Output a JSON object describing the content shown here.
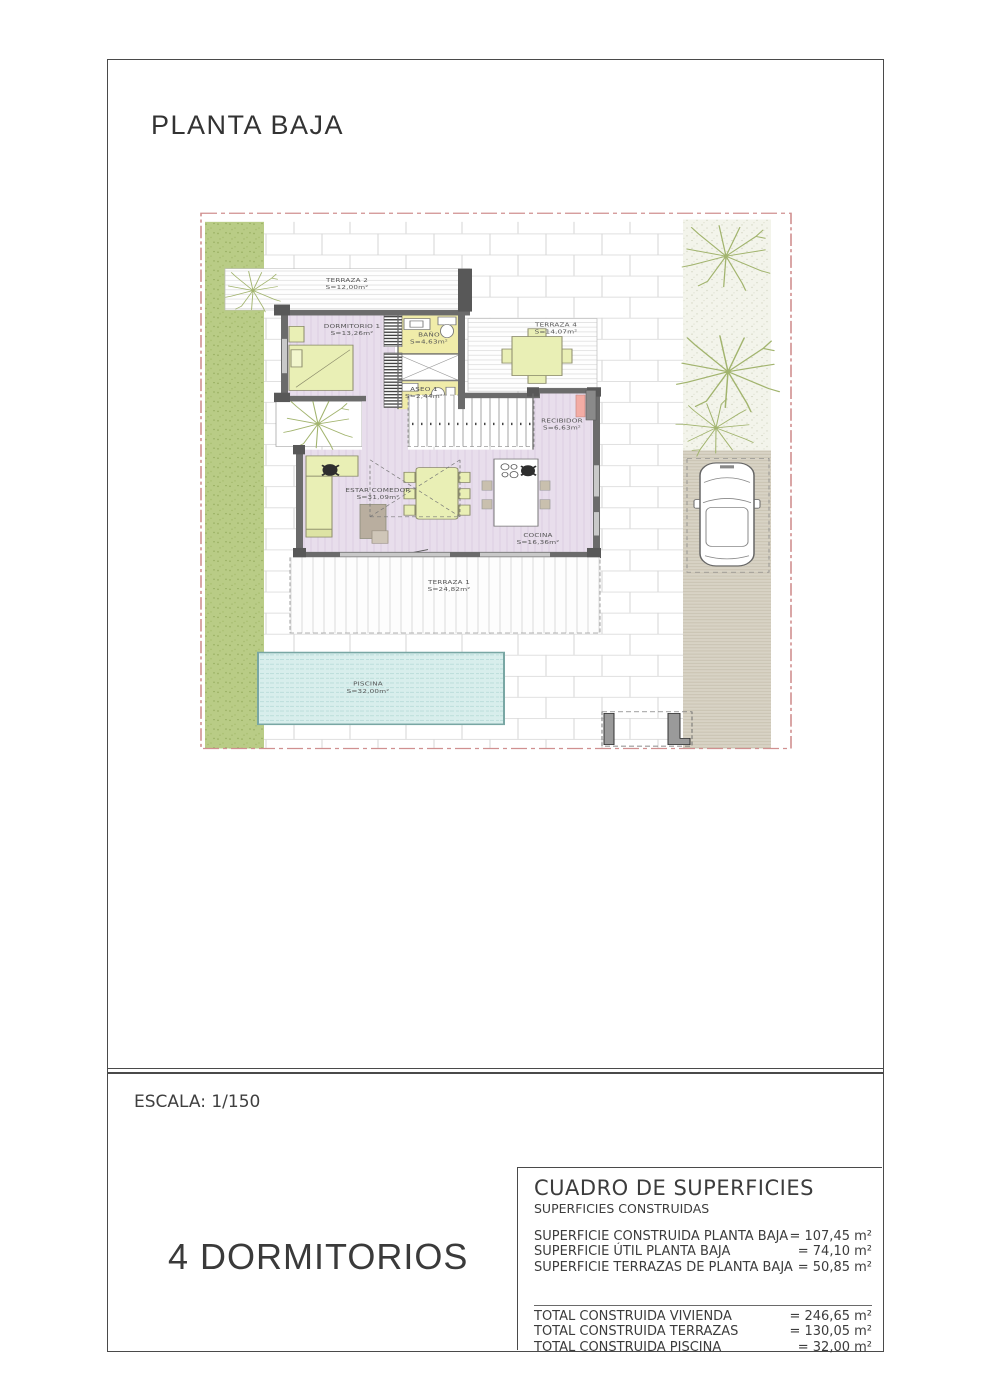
{
  "page": {
    "title": "PLANTA BAJA",
    "scale_label": "ESCALA: 1/150",
    "bedrooms_label": "4 DORMITORIOS"
  },
  "plan": {
    "rooms": [
      {
        "name": "TERRAZA 2",
        "area": "S=12,00m²"
      },
      {
        "name": "DORMITORIO 1",
        "area": "S=13,26m²"
      },
      {
        "name": "BAÑO",
        "area": "S=4,63m²"
      },
      {
        "name": "TERRAZA 4",
        "area": "S=14,07m²"
      },
      {
        "name": "ASEO 1",
        "area": "S=2,44m²"
      },
      {
        "name": "RECIBIDOR",
        "area": "S=6,63m²"
      },
      {
        "name": "ESTAR COMEDOR",
        "area": "S=31,09m²"
      },
      {
        "name": "COCINA",
        "area": "S=16,36m²"
      },
      {
        "name": "TERRAZA 1",
        "area": "S=24,82m²"
      },
      {
        "name": "PISCINA",
        "area": "S=32,00m²"
      }
    ]
  },
  "surfaces_table": {
    "title": "CUADRO DE SUPERFICIES",
    "subtitle": "SUPERFICIES CONSTRUIDAS",
    "rows": [
      {
        "label": "SUPERFICIE CONSTRUIDA PLANTA BAJA",
        "value": "= 107,45 m²"
      },
      {
        "label": "SUPERFICIE ÚTIL PLANTA BAJA",
        "value": "= 74,10 m²"
      },
      {
        "label": "SUPERFICIE TERRAZAS DE PLANTA BAJA",
        "value": "= 50,85 m²"
      }
    ],
    "totals": [
      {
        "label": "TOTAL CONSTRUIDA VIVIENDA",
        "value": "= 246,65 m²"
      },
      {
        "label": "TOTAL CONSTRUIDA TERRAZAS",
        "value": "= 130,05 m²"
      },
      {
        "label": "TOTAL CONSTRUIDA PISCINA",
        "value": "= 32,00 m²"
      }
    ]
  },
  "colors": {
    "boundary_red": "#d09090",
    "wall_grey": "#6b6b6b",
    "floor_purple": "#e8deec",
    "wet_room_yellow": "#f0eca9",
    "furniture_green": "#e9efb5",
    "grass_green": "#b9cc86",
    "pool_cyan": "#d8eeec",
    "driveway_beige": "#d8d3c5",
    "door_salmon": "#f3aca4"
  }
}
